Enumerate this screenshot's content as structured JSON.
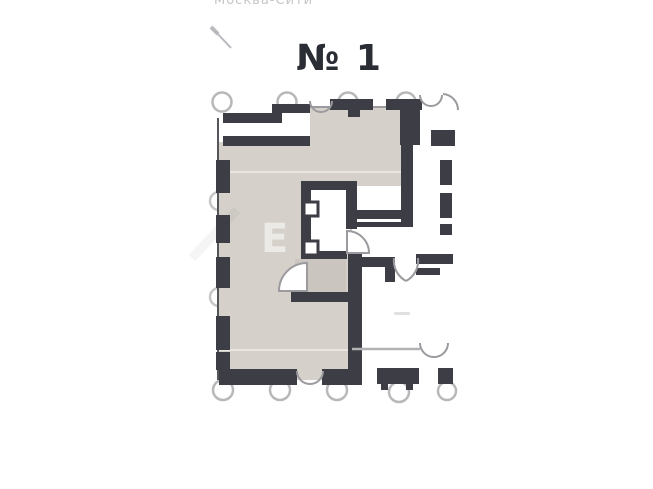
{
  "header": {
    "location_label": "Москва-Сити",
    "unit_number": "№ 1"
  },
  "plan": {
    "area_label": "268,9",
    "watermark_letter": "Е"
  },
  "colors": {
    "wall": "#3d3d45",
    "room": "#d5d1ca",
    "vestibule": "#cac6bf",
    "window_line": "#55555c",
    "door_line": "#9a9a9f",
    "circle_stroke": "#b8b8bb",
    "corridor_line": "#b2b2b5",
    "title_text": "#2a2d33",
    "area_text": "#26282e",
    "muted_text": "#c6c6c7",
    "arrow": "#b9b9bd",
    "faint_mark": "#c9c9cb"
  }
}
